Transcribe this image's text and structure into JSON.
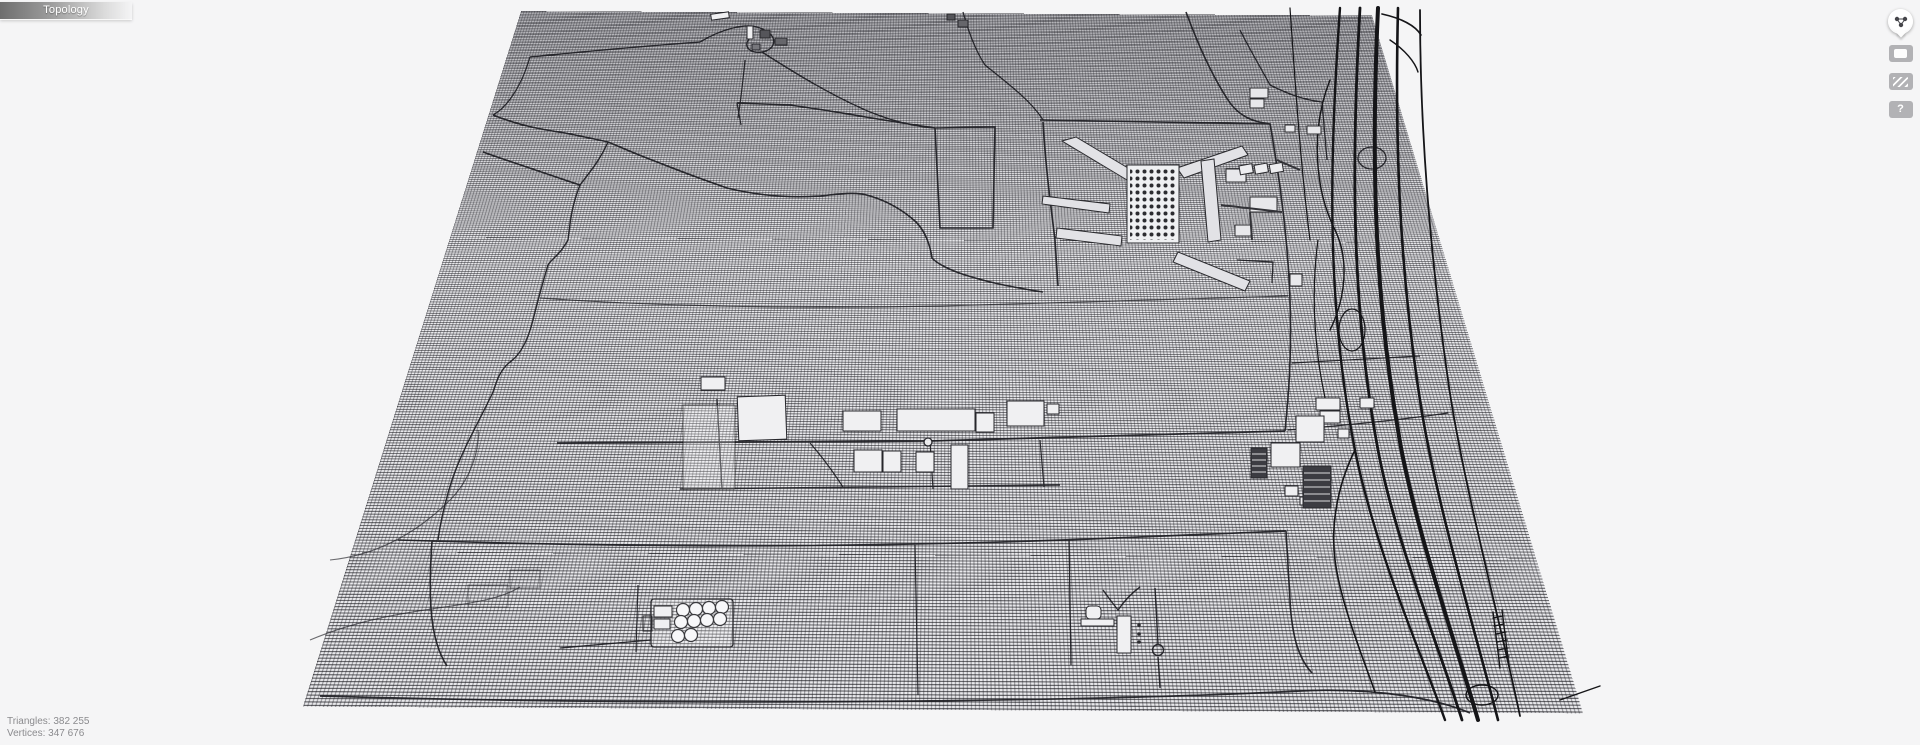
{
  "header": {
    "mode_label": "Topology"
  },
  "stats": {
    "triangles": {
      "label": "Triangles:",
      "value": "382 255"
    },
    "vertices": {
      "label": "Vertices:",
      "value": "347 676"
    }
  },
  "toolbar": {
    "orb": {
      "icon": "vertex-graph-icon"
    },
    "surface": {
      "icon": "flat-surface-icon"
    },
    "wireframe": {
      "icon": "wireframe-stripes-icon"
    },
    "help": {
      "icon": "help-icon",
      "label": "?"
    }
  },
  "scene": {
    "description": "wireframe topology view of scanned industrial terrain tile",
    "colors": {
      "background": "#f5f5f6",
      "mesh_fill": "#e9e9ec",
      "mesh_line": "#26262b",
      "road_line": "#1d1d22",
      "building_fill": "#f0f0f2",
      "dark_block_fill": "#3c3c42"
    }
  }
}
